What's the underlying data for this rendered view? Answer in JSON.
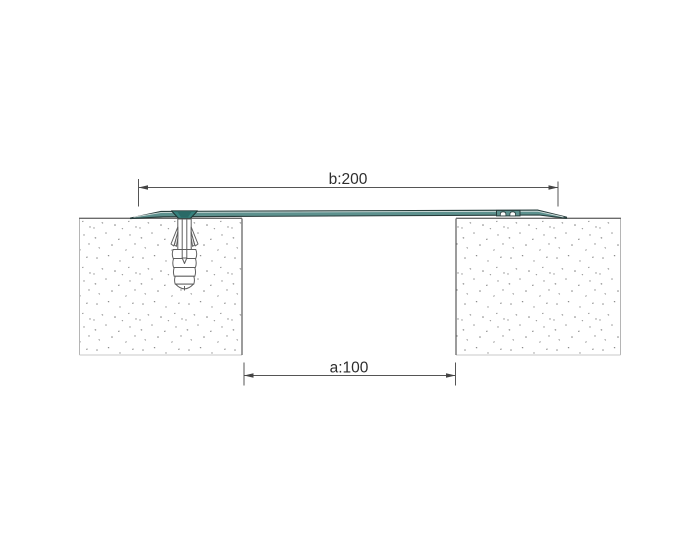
{
  "diagram": {
    "type": "technical-drawing",
    "subject": "expansion-joint-cover-profile-cross-section",
    "dimension_b": {
      "label": "b:200"
    },
    "dimension_a": {
      "label": "a:100"
    },
    "colors": {
      "background": "#ffffff",
      "profile_fill": "#5d918e",
      "profile_outline": "#273c3b",
      "profile_highlight": "#d2dedc",
      "screw_fill": "#35807c",
      "screw_inner": "#2a6a67",
      "dim_line": "#555555",
      "dim_text": "#2e2e2e",
      "surface_line": "#6b6b6b",
      "block_edge_light": "#b5b5b5",
      "block_edge_dark": "#5a5a5a",
      "concrete_speck": "#8c8c8c",
      "plug_outline": "#5f5f5f"
    },
    "parts": {
      "left_block": "concrete-substrate-left",
      "right_block": "concrete-substrate-right",
      "profile": "joint-cover-profile",
      "anchor": "screw-with-expansion-plug",
      "clip": "snap-clip-detail"
    }
  }
}
